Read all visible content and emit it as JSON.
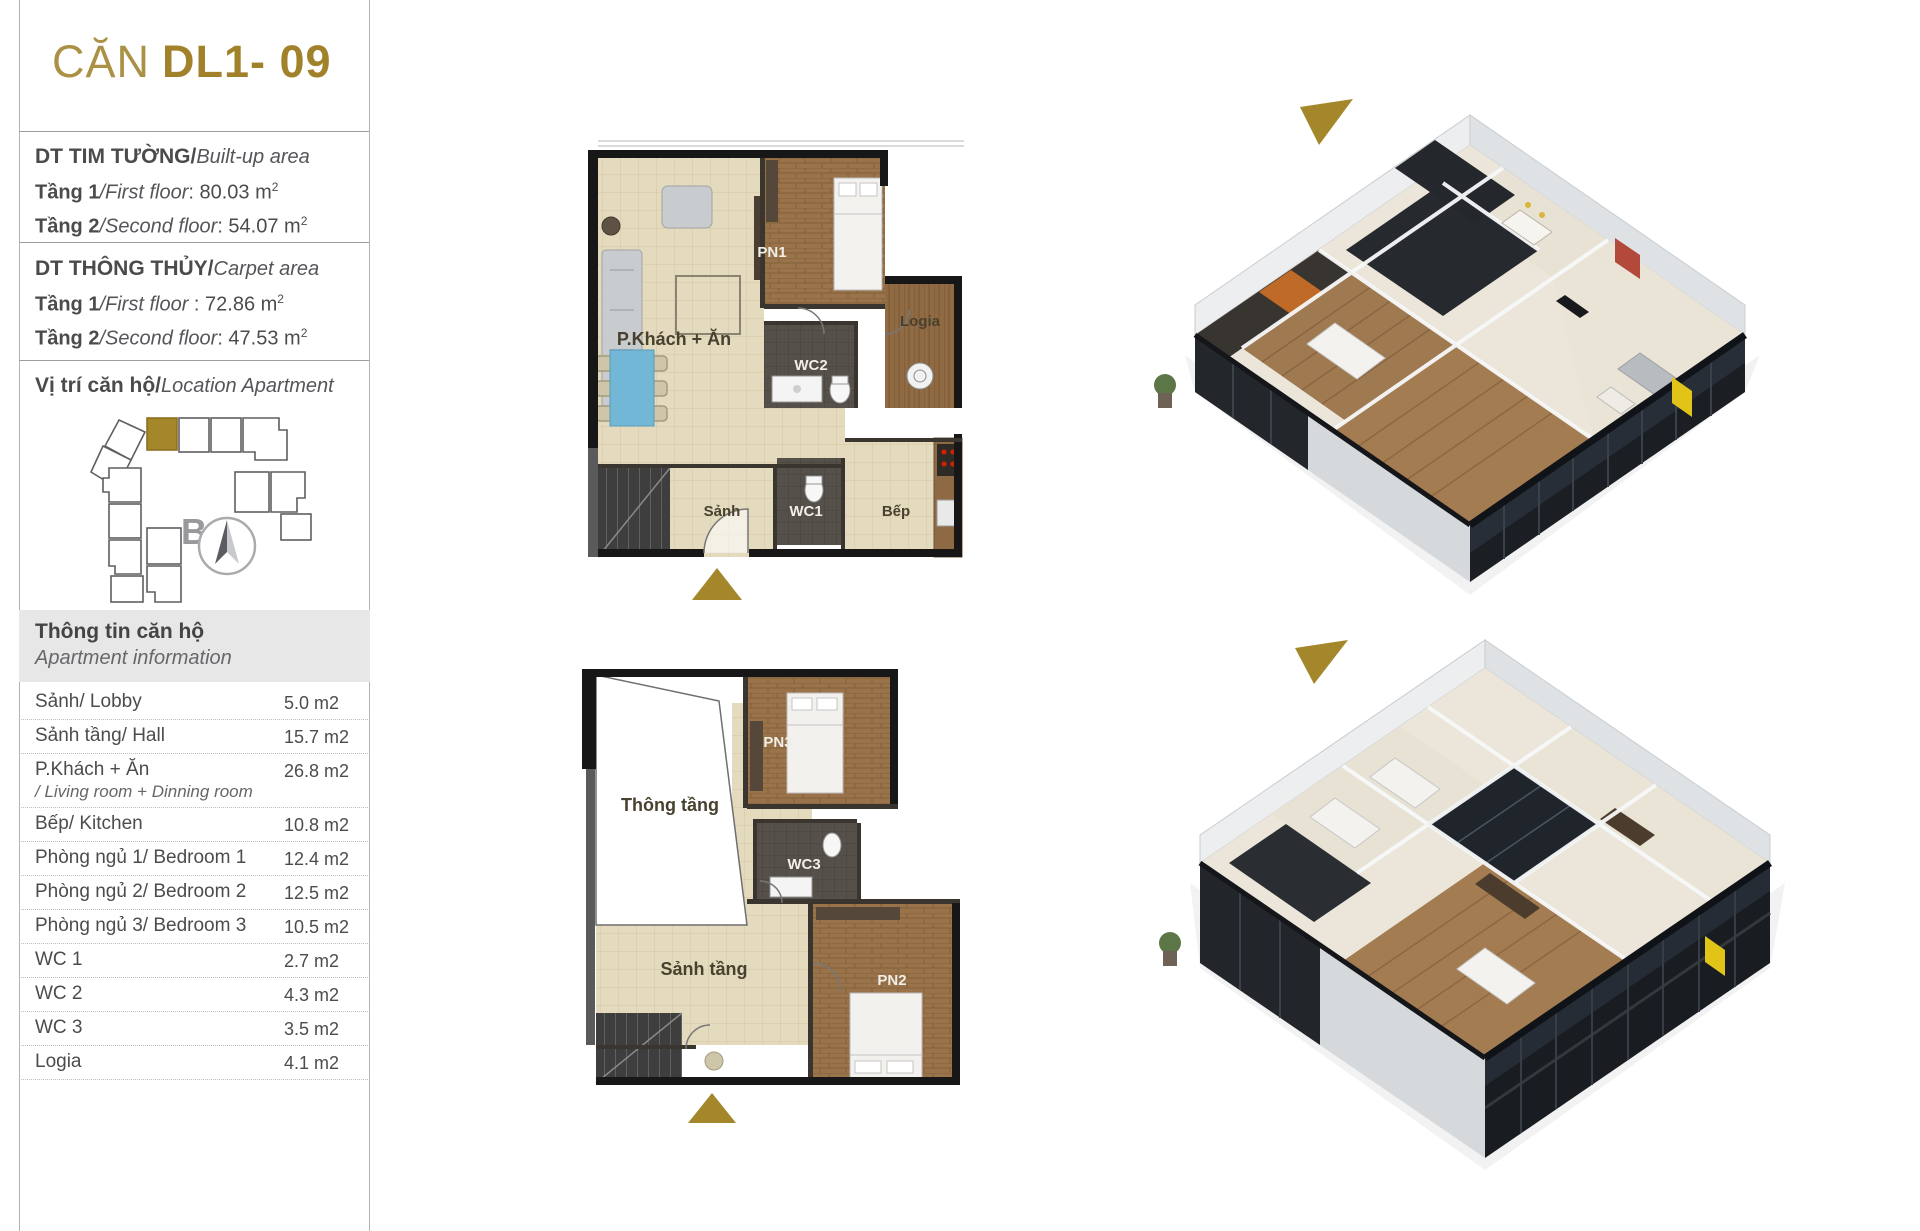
{
  "colors": {
    "gold": "#a5872b",
    "text_dark": "#4b4b4d",
    "header_bg": "#e7e7e7",
    "plan_beige": "#e4dabd",
    "plan_wood": "#9a734a",
    "glass_dark": "#1b1f24",
    "accent_yellow": "#e2c418"
  },
  "header": {
    "title_prefix": "CĂN",
    "title_code": "DL1- 09"
  },
  "built_up": {
    "title_vi": "DT TIM TƯỜNG/",
    "title_en": "Built-up area",
    "line1": {
      "bold": "Tầng 1",
      "italic": "/First floor",
      "rest": ": 80.03 m",
      "sup": "2"
    },
    "line2": {
      "bold": "Tầng 2",
      "italic": "/Second floor",
      "rest": ": 54.07 m",
      "sup": "2"
    }
  },
  "carpet": {
    "title_vi": "DT THÔNG THỦY/",
    "title_en": "Carpet area",
    "line1": {
      "bold": "Tầng 1",
      "italic": "/First floor ",
      "rest": ": 72.86 m",
      "sup": "2"
    },
    "line2": {
      "bold": "Tầng 2",
      "italic": "/Second floor",
      "rest": ": 47.53 m",
      "sup": "2"
    }
  },
  "location": {
    "title_vi": "Vị trí căn hộ/",
    "title_en": "Location Apartment",
    "compass_label": "B"
  },
  "info": {
    "title_vi": "Thông tin căn hộ",
    "title_en": "Apartment information",
    "rows": [
      {
        "label": "Sảnh/ Lobby",
        "value": "5.0 m2"
      },
      {
        "label": "Sảnh tầng/ Hall",
        "value": "15.7 m2"
      },
      {
        "label": "P.Khách + Ăn",
        "sublabel": "/ Living room + Dinning room",
        "value": "26.8 m2"
      },
      {
        "label": "Bếp/ Kitchen",
        "value": "10.8 m2"
      },
      {
        "label": "Phòng ngủ 1/ Bedroom 1",
        "value": "12.4 m2"
      },
      {
        "label": "Phòng ngủ 2/ Bedroom 2",
        "value": "12.5 m2"
      },
      {
        "label": "Phòng ngủ 3/ Bedroom 3",
        "value": "10.5 m2"
      },
      {
        "label": "WC 1",
        "value": "2.7 m2"
      },
      {
        "label": "WC 2",
        "value": "4.3 m2"
      },
      {
        "label": "WC 3",
        "value": "3.5 m2"
      },
      {
        "label": "Logia",
        "value": "4.1 m2"
      }
    ]
  },
  "plan1": {
    "labels": {
      "living": "P.Khách + Ăn",
      "bedroom1": "PN1",
      "logia": "Logia",
      "wc2": "WC2",
      "lobby": "Sảnh",
      "wc1": "WC1",
      "kitchen": "Bếp"
    }
  },
  "plan2": {
    "labels": {
      "void": "Thông tầng",
      "bedroom3": "PN3",
      "wc3": "WC3",
      "hall": "Sảnh tầng",
      "bedroom2": "PN2"
    }
  }
}
